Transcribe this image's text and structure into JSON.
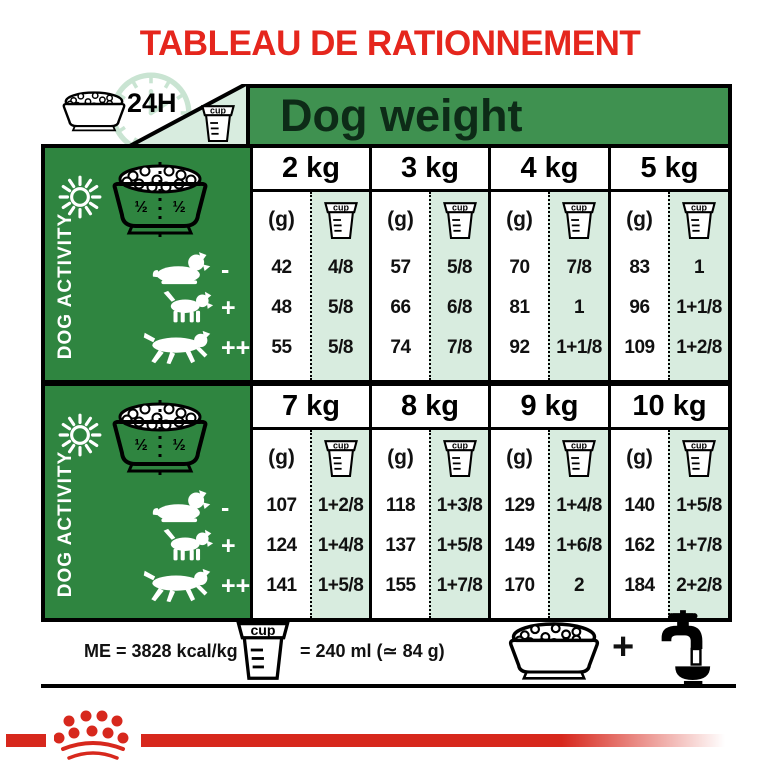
{
  "title": "TABLEAU DE RATIONNEMENT",
  "header": {
    "duration": "24H",
    "dog_weight": "Dog weight"
  },
  "icons": {
    "cup_text": "cup"
  },
  "activity_panel": {
    "label": "DOG ACTIVITY",
    "bowl_half_left": "½",
    "bowl_half_right": "½",
    "level_symbols": [
      "-",
      "+",
      "++"
    ]
  },
  "tables": [
    {
      "columns": [
        {
          "weight": "2 kg",
          "g_label": "(g)",
          "rows": [
            {
              "g": "42",
              "cup": "4/8"
            },
            {
              "g": "48",
              "cup": "5/8"
            },
            {
              "g": "55",
              "cup": "5/8"
            }
          ]
        },
        {
          "weight": "3 kg",
          "g_label": "(g)",
          "rows": [
            {
              "g": "57",
              "cup": "5/8"
            },
            {
              "g": "66",
              "cup": "6/8"
            },
            {
              "g": "74",
              "cup": "7/8"
            }
          ]
        },
        {
          "weight": "4 kg",
          "g_label": "(g)",
          "rows": [
            {
              "g": "70",
              "cup": "7/8"
            },
            {
              "g": "81",
              "cup": "1"
            },
            {
              "g": "92",
              "cup": "1+1/8"
            }
          ]
        },
        {
          "weight": "5 kg",
          "g_label": "(g)",
          "rows": [
            {
              "g": "83",
              "cup": "1"
            },
            {
              "g": "96",
              "cup": "1+1/8"
            },
            {
              "g": "109",
              "cup": "1+2/8"
            }
          ]
        }
      ]
    },
    {
      "columns": [
        {
          "weight": "7 kg",
          "g_label": "(g)",
          "rows": [
            {
              "g": "107",
              "cup": "1+2/8"
            },
            {
              "g": "124",
              "cup": "1+4/8"
            },
            {
              "g": "141",
              "cup": "1+5/8"
            }
          ]
        },
        {
          "weight": "8 kg",
          "g_label": "(g)",
          "rows": [
            {
              "g": "118",
              "cup": "1+3/8"
            },
            {
              "g": "137",
              "cup": "1+5/8"
            },
            {
              "g": "155",
              "cup": "1+7/8"
            }
          ]
        },
        {
          "weight": "9 kg",
          "g_label": "(g)",
          "rows": [
            {
              "g": "129",
              "cup": "1+4/8"
            },
            {
              "g": "149",
              "cup": "1+6/8"
            },
            {
              "g": "170",
              "cup": "2"
            }
          ]
        },
        {
          "weight": "10 kg",
          "g_label": "(g)",
          "rows": [
            {
              "g": "140",
              "cup": "1+5/8"
            },
            {
              "g": "162",
              "cup": "1+7/8"
            },
            {
              "g": "184",
              "cup": "2+2/8"
            }
          ]
        }
      ]
    }
  ],
  "footer": {
    "energy": "ME = 3828 kcal/kg",
    "cup_equivalence": "= 240 ml (≃ 84 g)",
    "plus": "+"
  },
  "colors": {
    "brand_red": "#d7281d",
    "title_red": "#e5261d",
    "panel_green": "#2f8540",
    "header_green": "#3f9150",
    "mint": "#d8ecdf",
    "pale_green": "#c9e4d2"
  }
}
